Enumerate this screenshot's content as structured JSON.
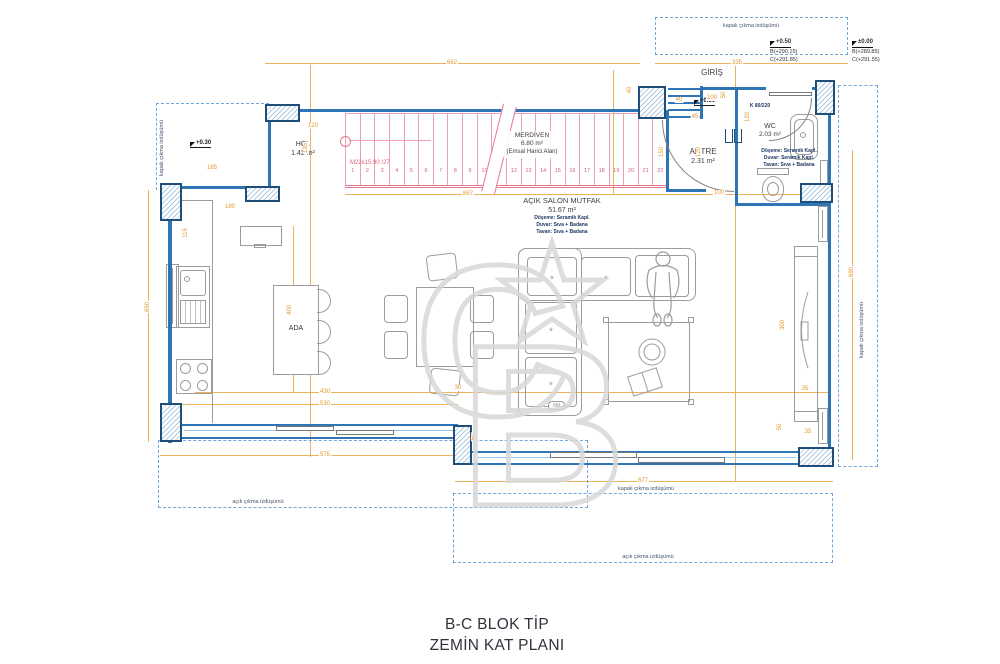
{
  "colors": {
    "wall": "#2e75b6",
    "column_border": "#1f4e79",
    "column_hatch": "#aec9e4",
    "dimension": "#e0992e",
    "stair": "#e2798f",
    "dashed_projection": "#6fa8dc",
    "furniture": "#9c9c9c",
    "spec_text": "#1f3864",
    "label_text": "#3c3c46",
    "watermark": "#d8d8d8"
  },
  "title": {
    "line1": "B-C BLOK TİP",
    "line2": "ZEMİN KAT PLANI"
  },
  "rooms": {
    "hol": {
      "name": "HOL",
      "area": "1.42 m²"
    },
    "merdiven": {
      "name": "MERDİVEN",
      "area": "6.80 m²",
      "note": "(Emsal Harici Alan)"
    },
    "giris": {
      "name": "GİRİŞ"
    },
    "antre": {
      "name": "ANTRE",
      "area": "2.31 m²"
    },
    "wc": {
      "name": "WC",
      "area": "2.03 m²",
      "specs": [
        "Döşeme: Seramik Kapl.",
        "Duvar: Seramik Kapl.",
        "Tavan: Sıva + Badana"
      ]
    },
    "salon": {
      "name": "AÇIK SALON MUTFAK",
      "area": "51.67 m²",
      "specs": [
        "Döşeme: Seramik Kapl.",
        "Duvar: Sıva + Badana",
        "Tavan: Sıva + Badana"
      ]
    },
    "ada": {
      "name": "ADA"
    }
  },
  "stair": {
    "spec_label": "M22x15.90 /27",
    "treads": [
      "1",
      "2",
      "3",
      "4",
      "5",
      "6",
      "7",
      "8",
      "9",
      "10",
      "11",
      "12",
      "13",
      "14",
      "15",
      "16",
      "17",
      "18",
      "19",
      "20",
      "21",
      "22"
    ]
  },
  "doors": {
    "wc_door": "K 80/220"
  },
  "elevations": {
    "left_marker": "+0.30",
    "entry_marker": "+0.50",
    "block1": {
      "main": "+0.50",
      "b": "B(+290.15)",
      "c": "C(+291.85)"
    },
    "block2": {
      "main": "±0.00",
      "b": "B(+289.85)",
      "c": "C(+291.55)"
    }
  },
  "projections": {
    "kapali": "kapalı çıkma izdüşümü",
    "acik": "açık çıkma izdüşümü"
  },
  "badges": {
    "sofa_badge": "6M"
  },
  "decorations": {
    "cushion_star": "*"
  },
  "dimensions": [
    {
      "t": "662",
      "x": 452,
      "y": 63
    },
    {
      "t": "335",
      "x": 737,
      "y": 63
    },
    {
      "t": "650",
      "x": 148,
      "y": 307,
      "r": 1
    },
    {
      "t": "690",
      "x": 852,
      "y": 272,
      "r": 1
    },
    {
      "t": "867",
      "x": 468,
      "y": 194
    },
    {
      "t": "120",
      "x": 313,
      "y": 126
    },
    {
      "t": "185",
      "x": 212,
      "y": 168
    },
    {
      "t": "180",
      "x": 230,
      "y": 207
    },
    {
      "t": "115",
      "x": 186,
      "y": 233,
      "r": 1
    },
    {
      "t": "135",
      "x": 306,
      "y": 148,
      "r": 1
    },
    {
      "t": "400",
      "x": 290,
      "y": 310,
      "r": 1
    },
    {
      "t": "430",
      "x": 325,
      "y": 392
    },
    {
      "t": "530",
      "x": 325,
      "y": 404
    },
    {
      "t": "575",
      "x": 325,
      "y": 455
    },
    {
      "t": "677",
      "x": 643,
      "y": 481
    },
    {
      "t": "40",
      "x": 630,
      "y": 90,
      "r": 1
    },
    {
      "t": "40",
      "x": 679,
      "y": 100
    },
    {
      "t": "100",
      "x": 712,
      "y": 98
    },
    {
      "t": "45",
      "x": 695,
      "y": 117
    },
    {
      "t": "50",
      "x": 724,
      "y": 95,
      "r": 1
    },
    {
      "t": "150",
      "x": 662,
      "y": 152,
      "r": 1
    },
    {
      "t": "120",
      "x": 699,
      "y": 152,
      "r": 1
    },
    {
      "t": "100",
      "x": 719,
      "y": 193
    },
    {
      "t": "120",
      "x": 748,
      "y": 117,
      "r": 1
    },
    {
      "t": "300",
      "x": 783,
      "y": 325,
      "r": 1
    },
    {
      "t": "35",
      "x": 805,
      "y": 389
    },
    {
      "t": "50",
      "x": 780,
      "y": 427,
      "r": 1
    },
    {
      "t": "35",
      "x": 808,
      "y": 432
    },
    {
      "t": "30",
      "x": 458,
      "y": 388
    },
    {
      "t": "50",
      "x": 474,
      "y": 437,
      "r": 1
    }
  ]
}
